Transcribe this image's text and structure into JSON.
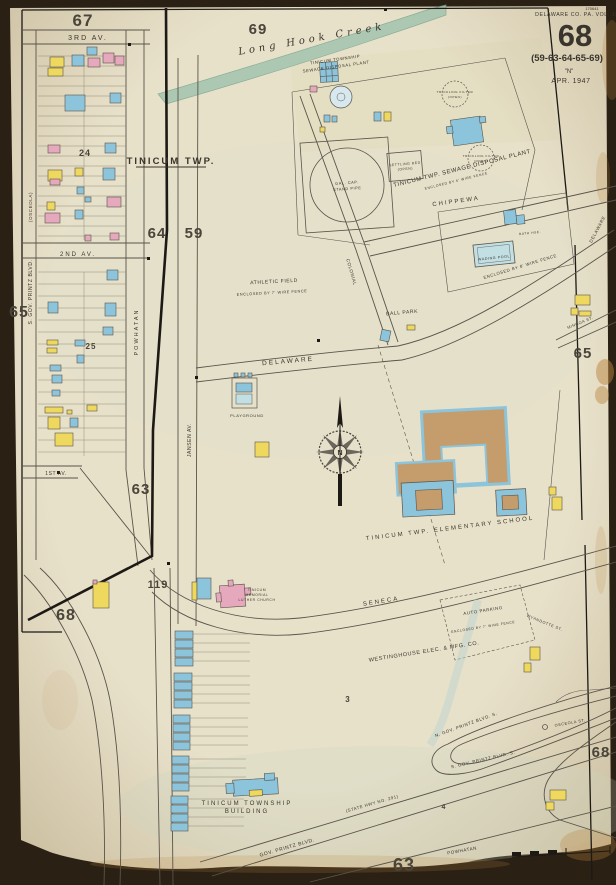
{
  "header": {
    "stamp": "170641",
    "vol_line": "DELAWARE CO. PA. VOL. 10",
    "sheet": "68",
    "refs": "(59-63-64-65-69)",
    "n_mark": "\"N\"",
    "date": "APR. 1947"
  },
  "sheets": {
    "s67": "67",
    "s69": "69",
    "s64": "64",
    "s59": "59",
    "s65l": "65",
    "s65r": "65",
    "s63c": "63",
    "s68bl": "68",
    "s63b": "63",
    "s68br": "68",
    "s119": "119"
  },
  "blocks": {
    "b24": "24",
    "b25": "25",
    "b3": "3",
    "b4": "4"
  },
  "streets": {
    "third": "3RD AV.",
    "second": "2ND AV.",
    "first": "1ST AV.",
    "twp": "TINICUM TWP.",
    "chippewa": "CHIPPEWA",
    "delaware": "DELAWARE",
    "colonial": "COLONIAL",
    "powhatan": "POWHATAN",
    "jansen": "JANSEN AV.",
    "seneca": "SENECA",
    "mingoa": "MINGOA ST.",
    "osceola": "(OSCEOLA)",
    "sgov": "S. GOV. PRINTZ BLVD.",
    "ngovs": "N. GOV. PRINTZ BLVD. S.",
    "sgovs": "S. GOV. PRINTZ BLVD. S.",
    "osceola_st": "OSCEOLA ST.",
    "wyandotte": "WYANDOTTE ST.",
    "govprintz": "GOV. PRINTZ BLVD.",
    "statehwy": "(STATE HWY NO. 291)"
  },
  "places": {
    "creek": "Long Hook Creek",
    "plant1": "TINICUM TOWNSHIP",
    "plant2": "SEWAGE DISPOSAL PLANT",
    "plant_d": "TINICUM TWP. SEWAGE DISPOSAL PLANT",
    "plant_f": "ENCLOSED BY 6' WIRE FENCE",
    "athletic": "ATHLETIC FIELD",
    "athletic_f": "ENCLOSED BY 7' WIRE FENCE",
    "ballpark": "BALL PARK",
    "playground": "PLAYGROUND",
    "wadepool": "WADING POOL",
    "bathhse": "BATH HSE.",
    "fence8": "ENCLOSED BY 8' WIRE FENCE",
    "school": "TINICUM TWP. ELEMENTARY SCHOOL",
    "church1": "TINICUM",
    "church2": "MEMORIAL",
    "church3": "LUTHER CHURCH",
    "westinghouse": "WESTINGHOUSE ELEC. & MFG. CO.",
    "parking": "AUTO PARKING",
    "parking_f": "ENCLOSED BY 7' WIRE FENCE",
    "twpbldg1": "TINICUM TOWNSHIP",
    "twpbldg2": "BUILDING",
    "standpipe1": "GAL. CAP.",
    "standpipe2": "STAND PIPE",
    "settling1": "SETTLING BED",
    "settling2": "(OPEN)",
    "trickling": "TRICKLING FILTER",
    "open": "(OPEN)",
    "compass_n": "N"
  },
  "colors": {
    "bg": "#2b2014",
    "paper": "#e8e1ca",
    "ink": "#3a352c",
    "line": "#5a544a",
    "bold": "#1d1915",
    "num": "#4a443a",
    "yellow": "#eed95e",
    "pink": "#e5a8bd",
    "blue": "#8cc4dc",
    "pool": "#c2dfe3",
    "brown": "#c59c6b",
    "creek": "#a3c4ae",
    "tint": "#cfe0d8",
    "stain": "#b9853e"
  }
}
